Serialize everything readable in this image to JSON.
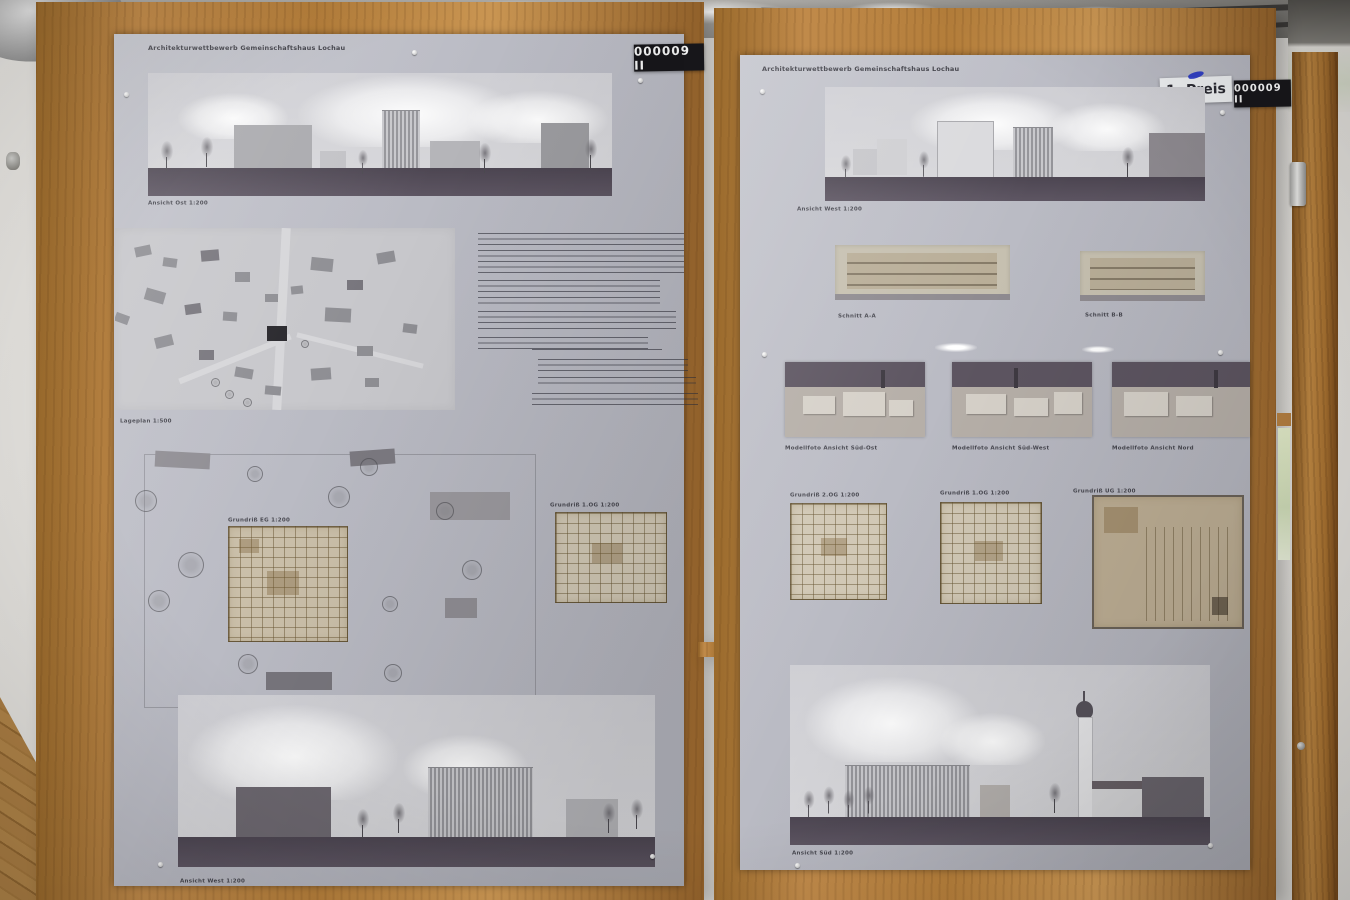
{
  "boards": {
    "left": {
      "header": "Architekturwettbewerb Gemeinschaftshaus Lochau",
      "entry_number": "000009 II",
      "captions": {
        "top_elevation": "Ansicht Ost 1:200",
        "site_plan": "Lageplan 1:500",
        "floor_plan_ground": "Grundriß EG 1:200",
        "floor_plan_upper": "Grundriß 1.OG 1:200",
        "bottom_elevation": "Ansicht West 1:200"
      }
    },
    "right": {
      "header": "Architekturwettbewerb Gemeinschaftshaus Lochau",
      "prize_label": "1. Preis",
      "entry_number": "000009 II",
      "captions": {
        "top_elevation": "Ansicht West 1:200",
        "section_a": "Schnitt A-A",
        "section_b": "Schnitt B-B",
        "model_photo_1": "Modellfoto Ansicht Süd-Ost",
        "model_photo_2": "Modellfoto Ansicht Süd-West",
        "model_photo_3": "Modellfoto Ansicht Nord",
        "floor_plan_2og": "Grundriß 2.OG 1:200",
        "floor_plan_1og": "Grundriß 1.OG 1:200",
        "floor_plan_ug": "Grundriß UG 1:200",
        "bottom_elevation": "Ansicht Süd 1:200"
      }
    }
  },
  "colors": {
    "badge-bg": "#17161a",
    "badge-text": "#f2f2f2",
    "plan-tan": "#cabfa9",
    "wood": "#b5813f",
    "poster": "#babbc3",
    "ground-band": "#5d5562",
    "wall": "#dcdad6",
    "floor-wood": "#a97a40"
  }
}
